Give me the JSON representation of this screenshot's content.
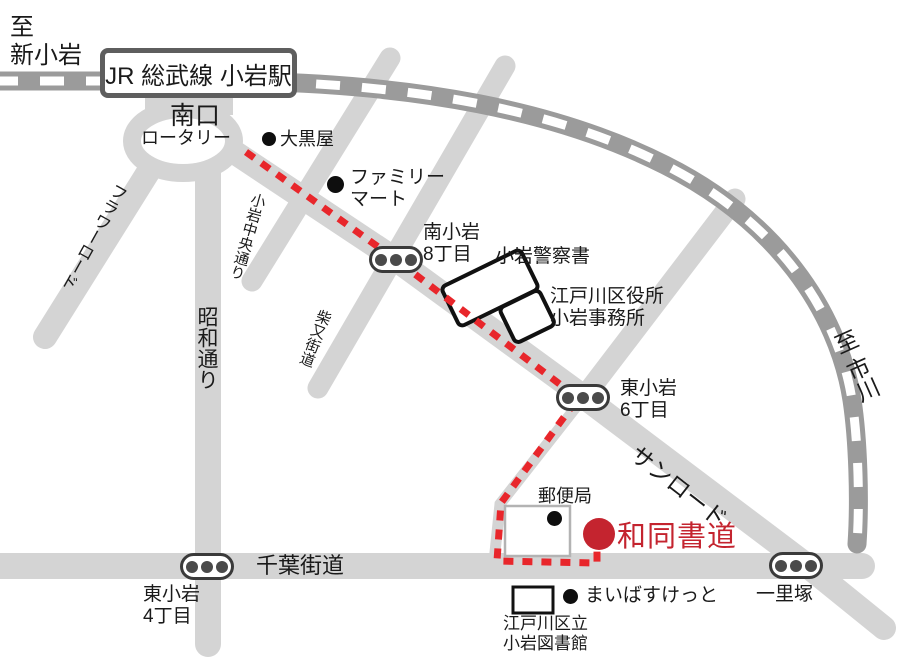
{
  "directions": {
    "to_shin_koiwa": "至\n新小岩",
    "to_ichikawa": "至 市川"
  },
  "station": {
    "name": "JR 総武線 小岩駅",
    "south_exit": "南口",
    "rotary": "ロータリー"
  },
  "roads": {
    "flower_road": "フラワーロード",
    "showa_dori": "昭和通り",
    "koiwa_chuo_dori": "小岩中央通り",
    "shibamata_kaido": "柴又街道",
    "sun_road": "サンロード",
    "chiba_kaido": "千葉街道"
  },
  "signals": {
    "minami_koiwa_8": "南小岩\n8丁目",
    "higashi_koiwa_6": "東小岩\n6丁目",
    "higashi_koiwa_4": "東小岩\n4丁目",
    "ichirizuka": "一里塚"
  },
  "landmarks": {
    "daikokuya": "大黒屋",
    "family_mart": "ファミリー\nマート",
    "police_station": "小岩警察書",
    "ward_office": "江戸川区役所\n小岩事務所",
    "post_office": "郵便局",
    "my_basket": "まいばすけっと",
    "library": "江戸川区立\n小岩図書館"
  },
  "destination": {
    "name": "和同書道"
  },
  "colors": {
    "road": "#d4d4d4",
    "railway": "#9b9b9b",
    "route": "#e8262b",
    "destination": "#c4242f"
  }
}
